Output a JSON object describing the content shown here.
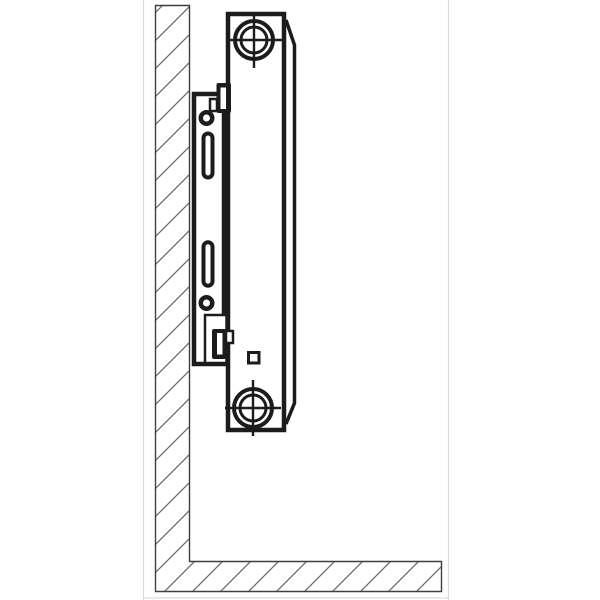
{
  "colors": {
    "background": "#ffffff",
    "line": "#1c1c1c",
    "hatch": "#6b6b6b",
    "wall_outline": "#3f3f3f",
    "frame": "#dcdcdc"
  },
  "diagram": {
    "type": "technical-line-drawing",
    "parts": [
      "wall-and-floor-cross-section",
      "radiator-panel-side-view",
      "radiator-back-edge-chamfered",
      "top-connection-port-crosshair",
      "bottom-connection-port-crosshair",
      "drain-plug-square",
      "wall-mounting-bracket-rail",
      "bracket-round-hole-top",
      "bracket-slot-top",
      "bracket-slot-bottom",
      "bracket-round-hole-bottom",
      "bracket-hook-top",
      "bracket-hook-bottom",
      "bracket-bottom-notch"
    ]
  }
}
